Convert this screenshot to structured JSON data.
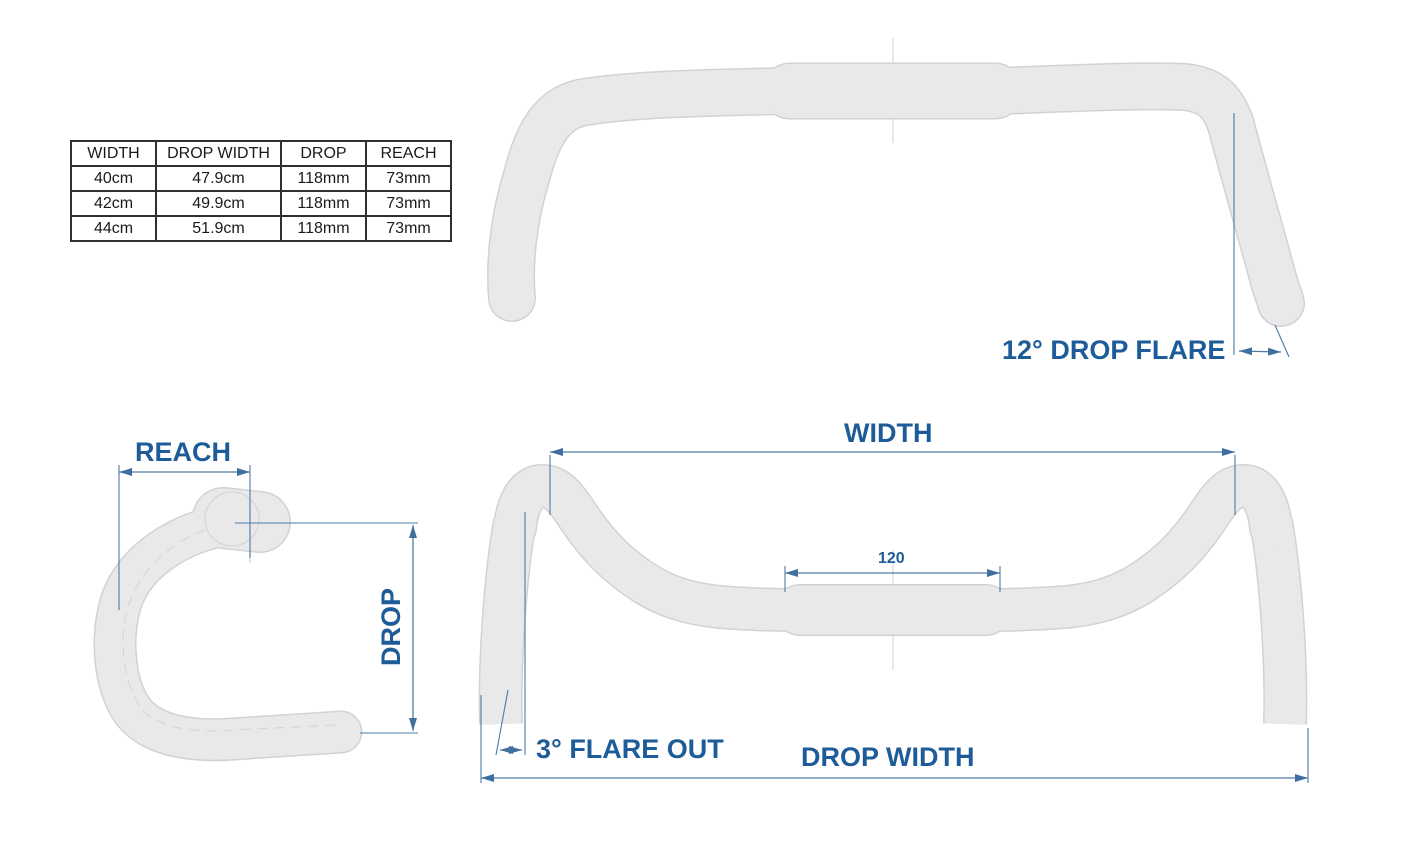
{
  "page": {
    "background": "#ffffff"
  },
  "colors": {
    "label_blue": "#1d5c99",
    "dimension_line": "#4d7ba8",
    "tube_fill": "#e9e9ea",
    "tube_outline": "#d2d2d4",
    "table_border": "#2f2f2f"
  },
  "spec_table": {
    "headers": [
      "WIDTH",
      "DROP WIDTH",
      "DROP",
      "REACH"
    ],
    "rows": [
      [
        "40cm",
        "47.9cm",
        "118mm",
        "73mm"
      ],
      [
        "42cm",
        "49.9cm",
        "118mm",
        "73mm"
      ],
      [
        "44cm",
        "51.9cm",
        "118mm",
        "73mm"
      ]
    ]
  },
  "views": {
    "top": {
      "title": "handlebar top view",
      "annotations": {
        "drop_flare": "12° DROP FLARE"
      }
    },
    "side": {
      "title": "handlebar side view",
      "annotations": {
        "reach": "REACH",
        "drop": "DROP"
      }
    },
    "front": {
      "title": "handlebar front view",
      "annotations": {
        "width": "WIDTH",
        "clamp_length": "120",
        "flare_out": "3° FLARE OUT",
        "drop_width": "DROP WIDTH"
      }
    }
  }
}
